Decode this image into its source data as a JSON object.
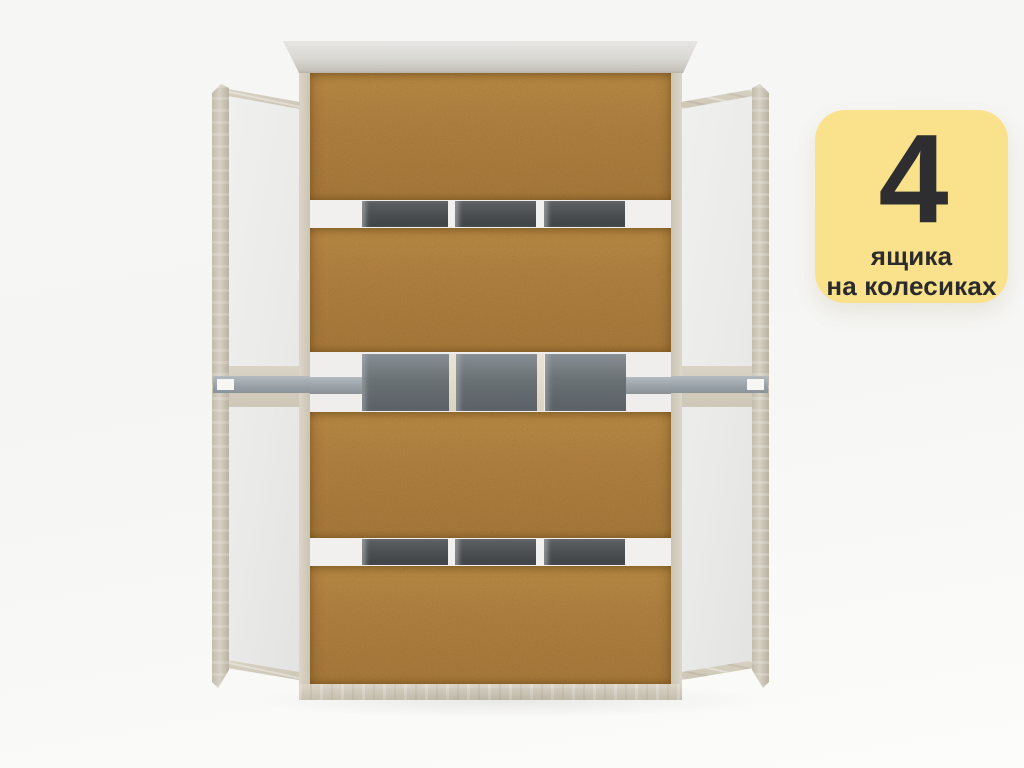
{
  "image": {
    "type": "product-render",
    "subject": "bed frame top view with four pull-out drawers on castor wheels",
    "background_color": "#F6F6F4"
  },
  "badge": {
    "number": "4",
    "caption_line1": "ящика",
    "caption_line2": "на колесиках",
    "background_color": "#F9E28B",
    "text_color": "#2E2E30"
  },
  "scene_colors": {
    "chipboard_drawer_bottom": "#B08140",
    "frame_wood": "#D3CCBE",
    "side_panel_white": "#EAEAE9",
    "metal_slat_dark": "#4B4E51",
    "metal_slat_mid": "#6B7276",
    "drawer_rail_gray": "#9BA3A9",
    "headboard_gray": "#DAD8D3"
  }
}
